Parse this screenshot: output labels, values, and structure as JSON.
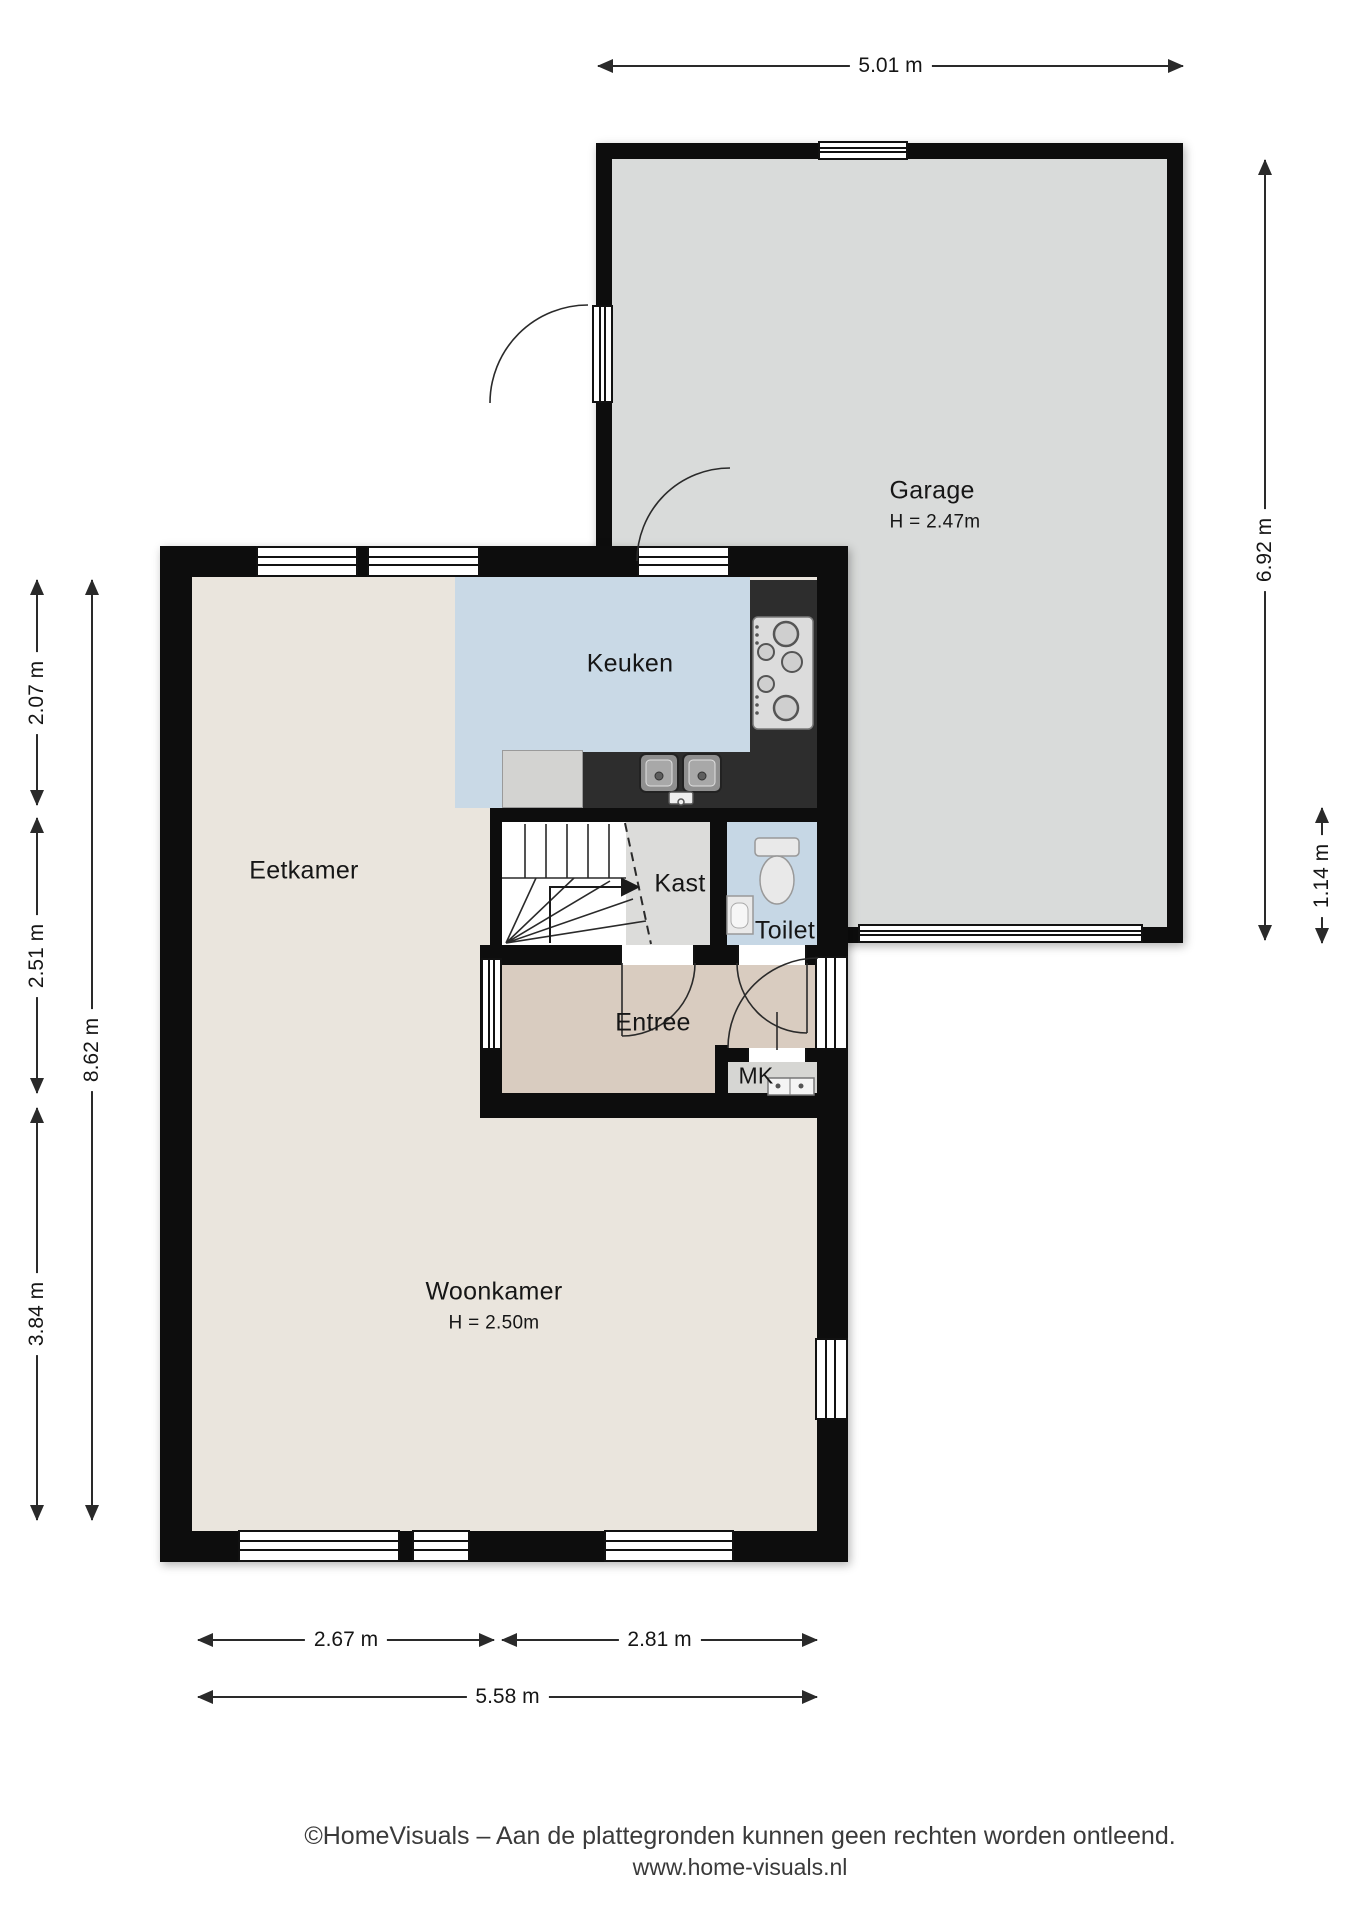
{
  "rooms": {
    "garage": {
      "name": "Garage",
      "height": "H = 2.47m"
    },
    "keuken": {
      "name": "Keuken"
    },
    "eetkamer": {
      "name": "Eetkamer"
    },
    "kast": {
      "name": "Kast"
    },
    "toilet": {
      "name": "Toilet"
    },
    "entree": {
      "name": "Entree"
    },
    "mk": {
      "name": "MK"
    },
    "woonkamer": {
      "name": "Woonkamer",
      "height": "H = 2.50m"
    }
  },
  "dimensions": {
    "top_width": "5.01 m",
    "garage_height": "6.92 m",
    "garage_offset": "1.14 m",
    "left_upper": "2.07 m",
    "left_middle": "2.51 m",
    "left_lower": "3.84 m",
    "left_total": "8.62 m",
    "bottom_left": "2.67 m",
    "bottom_right": "2.81 m",
    "bottom_total": "5.58 m"
  },
  "footer": {
    "line1": "©HomeVisuals – Aan de plattegronden kunnen geen rechten worden ontleend.",
    "line2": "www.home-visuals.nl"
  },
  "colors": {
    "wall": "#0d0d0d",
    "garage_floor": "#d9dbda",
    "living_floor": "#eae5dd",
    "kitchen_floor": "#c9d9e6",
    "toilet_floor": "#c6d7e5",
    "entry_floor": "#d9ccc0",
    "closet_floor": "#dcdcda",
    "mk_floor": "#d6d6d3",
    "counter": "#2d2d2d",
    "appliance": "#d3d3d1",
    "line": "#2a2a2a"
  }
}
